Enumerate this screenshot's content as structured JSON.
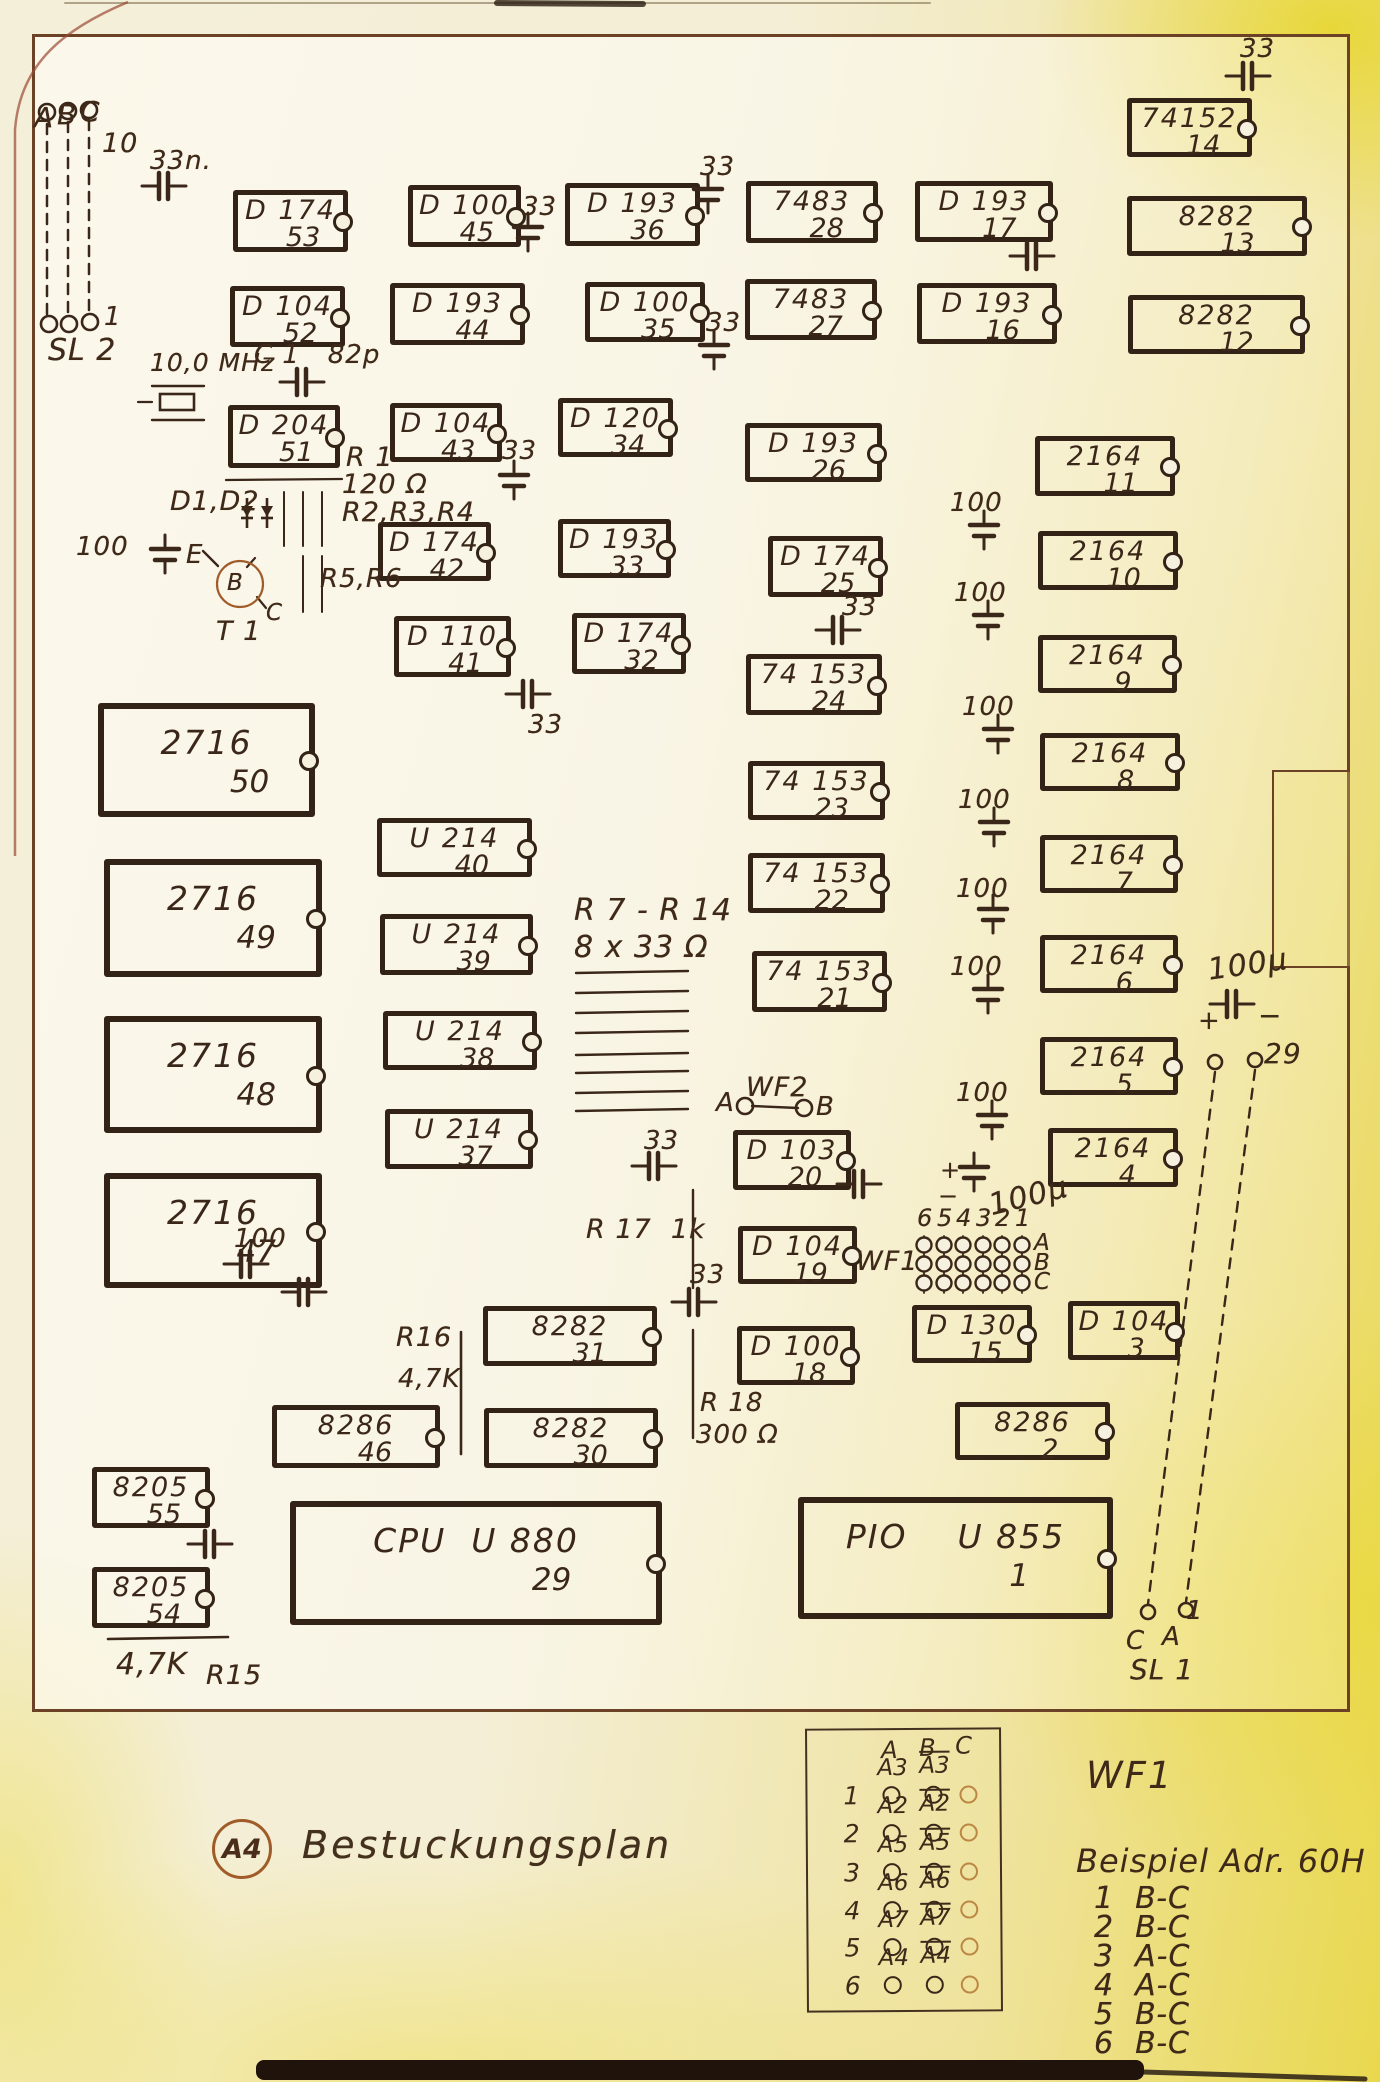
{
  "sheet": {
    "stamp": "A4",
    "caption": "Bestuckungsplan",
    "wf1_title": "WF1",
    "beispiel_title": "Beispiel  Adr. 60H"
  },
  "board": {
    "x": 32,
    "y": 34,
    "w": 1318,
    "h": 1678
  },
  "notch": {
    "x": 1272,
    "y": 770,
    "w": 78,
    "h": 198
  },
  "ics": [
    {
      "t": "D 174",
      "n": "53",
      "x": 233,
      "y": 190,
      "w": 115,
      "h": 62
    },
    {
      "t": "D 100",
      "n": "45",
      "x": 408,
      "y": 185,
      "w": 113,
      "h": 62
    },
    {
      "t": "D 193",
      "n": "36",
      "x": 565,
      "y": 183,
      "w": 135,
      "h": 63
    },
    {
      "t": "7483",
      "n": "28",
      "x": 746,
      "y": 181,
      "w": 132,
      "h": 62
    },
    {
      "t": "D 193",
      "n": "17",
      "x": 915,
      "y": 181,
      "w": 138,
      "h": 61
    },
    {
      "t": "74152",
      "n": "14",
      "x": 1127,
      "y": 98,
      "w": 125,
      "h": 59
    },
    {
      "t": "8282",
      "n": "13",
      "x": 1127,
      "y": 196,
      "w": 180,
      "h": 60
    },
    {
      "t": "D 104",
      "n": "52",
      "x": 230,
      "y": 286,
      "w": 115,
      "h": 61
    },
    {
      "t": "D 193",
      "n": "44",
      "x": 390,
      "y": 283,
      "w": 135,
      "h": 62
    },
    {
      "t": "D 100",
      "n": "35",
      "x": 585,
      "y": 282,
      "w": 120,
      "h": 60
    },
    {
      "t": "7483",
      "n": "27",
      "x": 745,
      "y": 279,
      "w": 132,
      "h": 61
    },
    {
      "t": "D 193",
      "n": "16",
      "x": 917,
      "y": 283,
      "w": 140,
      "h": 61
    },
    {
      "t": "8282",
      "n": "12",
      "x": 1128,
      "y": 295,
      "w": 177,
      "h": 59
    },
    {
      "t": "D 204",
      "n": "51",
      "x": 228,
      "y": 405,
      "w": 112,
      "h": 63
    },
    {
      "t": "D 104",
      "n": "43",
      "x": 390,
      "y": 403,
      "w": 112,
      "h": 59
    },
    {
      "t": "D 120",
      "n": "34",
      "x": 558,
      "y": 398,
      "w": 115,
      "h": 59
    },
    {
      "t": "D 193",
      "n": "26",
      "x": 745,
      "y": 423,
      "w": 137,
      "h": 59
    },
    {
      "t": "2164",
      "n": "11",
      "x": 1035,
      "y": 436,
      "w": 140,
      "h": 60
    },
    {
      "t": "D 174",
      "n": "42",
      "x": 378,
      "y": 522,
      "w": 113,
      "h": 59
    },
    {
      "t": "D 193",
      "n": "33",
      "x": 558,
      "y": 519,
      "w": 113,
      "h": 59
    },
    {
      "t": "D 174",
      "n": "25",
      "x": 768,
      "y": 536,
      "w": 115,
      "h": 61
    },
    {
      "t": "2164",
      "n": "10",
      "x": 1038,
      "y": 531,
      "w": 140,
      "h": 59
    },
    {
      "t": "D 110",
      "n": "41",
      "x": 394,
      "y": 616,
      "w": 117,
      "h": 61
    },
    {
      "t": "D 174",
      "n": "32",
      "x": 572,
      "y": 613,
      "w": 114,
      "h": 61
    },
    {
      "t": "74 153",
      "n": "24",
      "x": 746,
      "y": 654,
      "w": 136,
      "h": 61
    },
    {
      "t": "2164",
      "n": "9",
      "x": 1038,
      "y": 635,
      "w": 139,
      "h": 58
    },
    {
      "t": "2716",
      "n": "50",
      "x": 98,
      "y": 703,
      "w": 217,
      "h": 114,
      "big": 1
    },
    {
      "t": "U 214",
      "n": "40",
      "x": 377,
      "y": 818,
      "w": 155,
      "h": 59
    },
    {
      "t": "74 153",
      "n": "23",
      "x": 748,
      "y": 761,
      "w": 137,
      "h": 59
    },
    {
      "t": "2164",
      "n": "8",
      "x": 1040,
      "y": 733,
      "w": 140,
      "h": 58
    },
    {
      "t": "2716",
      "n": "49",
      "x": 104,
      "y": 859,
      "w": 218,
      "h": 118,
      "big": 1
    },
    {
      "t": "U 214",
      "n": "39",
      "x": 380,
      "y": 914,
      "w": 153,
      "h": 61
    },
    {
      "t": "74 153",
      "n": "22",
      "x": 748,
      "y": 853,
      "w": 137,
      "h": 60
    },
    {
      "t": "2164",
      "n": "7",
      "x": 1040,
      "y": 835,
      "w": 138,
      "h": 58
    },
    {
      "t": "U 214",
      "n": "38",
      "x": 383,
      "y": 1011,
      "w": 154,
      "h": 59
    },
    {
      "t": "74 153",
      "n": "21",
      "x": 752,
      "y": 951,
      "w": 135,
      "h": 61
    },
    {
      "t": "2164",
      "n": "6",
      "x": 1040,
      "y": 935,
      "w": 138,
      "h": 58
    },
    {
      "t": "2716",
      "n": "48",
      "x": 104,
      "y": 1016,
      "w": 218,
      "h": 117,
      "big": 1
    },
    {
      "t": "U 214",
      "n": "37",
      "x": 385,
      "y": 1109,
      "w": 148,
      "h": 60
    },
    {
      "t": "2164",
      "n": "5",
      "x": 1040,
      "y": 1037,
      "w": 138,
      "h": 58
    },
    {
      "t": "2716",
      "n": "47",
      "x": 104,
      "y": 1173,
      "w": 218,
      "h": 115,
      "big": 1
    },
    {
      "t": "D 103",
      "n": "20",
      "x": 733,
      "y": 1130,
      "w": 118,
      "h": 60
    },
    {
      "t": "2164",
      "n": "4",
      "x": 1048,
      "y": 1128,
      "w": 130,
      "h": 59
    },
    {
      "t": "D 104",
      "n": "19",
      "x": 738,
      "y": 1226,
      "w": 119,
      "h": 58
    },
    {
      "t": "D 100",
      "n": "18",
      "x": 737,
      "y": 1326,
      "w": 118,
      "h": 59
    },
    {
      "t": "D 130",
      "n": "15",
      "x": 912,
      "y": 1305,
      "w": 120,
      "h": 58
    },
    {
      "t": "D 104",
      "n": "3",
      "x": 1068,
      "y": 1301,
      "w": 112,
      "h": 59
    },
    {
      "t": "8282",
      "n": "31",
      "x": 483,
      "y": 1306,
      "w": 174,
      "h": 60
    },
    {
      "t": "8286",
      "n": "46",
      "x": 272,
      "y": 1405,
      "w": 168,
      "h": 63
    },
    {
      "t": "8282",
      "n": "30",
      "x": 484,
      "y": 1408,
      "w": 174,
      "h": 60
    },
    {
      "t": "8205",
      "n": "55",
      "x": 92,
      "y": 1467,
      "w": 118,
      "h": 61
    },
    {
      "t": "8205",
      "n": "54",
      "x": 92,
      "y": 1567,
      "w": 118,
      "h": 61
    },
    {
      "t": "8286",
      "n": "2",
      "x": 955,
      "y": 1402,
      "w": 155,
      "h": 58
    },
    {
      "t": "CPU  U 880",
      "n": "29",
      "x": 290,
      "y": 1501,
      "w": 372,
      "h": 124,
      "big": 1
    },
    {
      "t": "PIO    U 855",
      "n": "1",
      "x": 798,
      "y": 1497,
      "w": 315,
      "h": 122,
      "big": 1
    }
  ],
  "caps": [
    {
      "o": "h",
      "x": 162,
      "y": 186,
      "lab": "33n.",
      "lx": 150,
      "ly": 148
    },
    {
      "o": "v",
      "x": 528,
      "y": 230,
      "lab": "33",
      "lx": 522,
      "ly": 194
    },
    {
      "o": "v",
      "x": 708,
      "y": 192,
      "lab": "33",
      "lx": 700,
      "ly": 154
    },
    {
      "o": "v",
      "x": 714,
      "y": 348,
      "lab": "33",
      "lx": 706,
      "ly": 310
    },
    {
      "o": "h",
      "x": 1246,
      "y": 76,
      "lab": "33",
      "lx": 1240,
      "ly": 36
    },
    {
      "o": "h",
      "x": 1030,
      "y": 256
    },
    {
      "o": "h",
      "x": 300,
      "y": 382,
      "lab": "C 1   82p",
      "lx": 254,
      "ly": 342
    },
    {
      "o": "v",
      "x": 514,
      "y": 478,
      "lab": "33",
      "lx": 502,
      "ly": 438
    },
    {
      "o": "h",
      "x": 836,
      "y": 630,
      "lab": "33",
      "lx": 842,
      "ly": 594
    },
    {
      "o": "h",
      "x": 526,
      "y": 694,
      "lab": "33",
      "lx": 528,
      "ly": 712
    },
    {
      "o": "v",
      "x": 165,
      "y": 552
    },
    {
      "o": "v",
      "x": 984,
      "y": 528,
      "lab": "100",
      "lx": 950,
      "ly": 490
    },
    {
      "o": "v",
      "x": 988,
      "y": 618,
      "lab": "100",
      "lx": 954,
      "ly": 580
    },
    {
      "o": "v",
      "x": 998,
      "y": 732,
      "lab": "100",
      "lx": 962,
      "ly": 694
    },
    {
      "o": "v",
      "x": 994,
      "y": 825,
      "lab": "100",
      "lx": 958,
      "ly": 787
    },
    {
      "o": "v",
      "x": 993,
      "y": 912,
      "lab": "100",
      "lx": 956,
      "ly": 876
    },
    {
      "o": "v",
      "x": 988,
      "y": 992,
      "lab": "100",
      "lx": 950,
      "ly": 954
    },
    {
      "o": "v",
      "x": 992,
      "y": 1118,
      "lab": "100",
      "lx": 956,
      "ly": 1080
    },
    {
      "o": "h",
      "x": 1230,
      "y": 1004
    },
    {
      "o": "v",
      "x": 974,
      "y": 1170
    },
    {
      "o": "h",
      "x": 857,
      "y": 1184
    },
    {
      "o": "h",
      "x": 652,
      "y": 1166,
      "lab": "33",
      "lx": 644,
      "ly": 1128
    },
    {
      "o": "h",
      "x": 692,
      "y": 1302,
      "lab": "33",
      "lx": 690,
      "ly": 1262
    },
    {
      "o": "h",
      "x": 244,
      "y": 1264,
      "lab": "100",
      "lx": 234,
      "ly": 1226
    },
    {
      "o": "h",
      "x": 302,
      "y": 1292
    },
    {
      "o": "h",
      "x": 208,
      "y": 1544
    }
  ],
  "labels": [
    {
      "t": "A",
      "x": 34,
      "y": 104,
      "s": 28
    },
    {
      "t": "B",
      "x": 57,
      "y": 101,
      "s": 28
    },
    {
      "t": "C",
      "x": 80,
      "y": 98,
      "s": 28
    },
    {
      "t": "10",
      "x": 102,
      "y": 130,
      "s": 27
    },
    {
      "t": "1",
      "x": 104,
      "y": 304,
      "s": 26
    },
    {
      "t": "SL 2",
      "x": 48,
      "y": 336,
      "s": 30
    },
    {
      "t": "10,0 MHz",
      "x": 150,
      "y": 350,
      "s": 25
    },
    {
      "t": "R 1",
      "x": 346,
      "y": 444,
      "s": 27
    },
    {
      "t": "120 Ω",
      "x": 342,
      "y": 471,
      "s": 27
    },
    {
      "t": "R2,R3,R4",
      "x": 342,
      "y": 499,
      "s": 27
    },
    {
      "t": "D1,D2",
      "x": 170,
      "y": 488,
      "s": 27
    },
    {
      "t": "100",
      "x": 76,
      "y": 534,
      "s": 26
    },
    {
      "t": "E",
      "x": 186,
      "y": 542,
      "s": 26
    },
    {
      "t": "B",
      "x": 227,
      "y": 572,
      "s": 23
    },
    {
      "t": "C",
      "x": 266,
      "y": 602,
      "s": 23
    },
    {
      "t": "T 1",
      "x": 216,
      "y": 618,
      "s": 27
    },
    {
      "t": "R5,R6",
      "x": 320,
      "y": 566,
      "s": 26
    },
    {
      "t": "R 7 - R 14",
      "x": 574,
      "y": 896,
      "s": 30
    },
    {
      "t": "8 x 33 Ω",
      "x": 574,
      "y": 933,
      "s": 30
    },
    {
      "t": "WF2",
      "x": 746,
      "y": 1074,
      "s": 27
    },
    {
      "t": "A",
      "x": 716,
      "y": 1090,
      "s": 26
    },
    {
      "t": "B",
      "x": 816,
      "y": 1094,
      "s": 26
    },
    {
      "t": "R 17  1k",
      "x": 586,
      "y": 1216,
      "s": 27
    },
    {
      "t": "R16",
      "x": 396,
      "y": 1324,
      "s": 27
    },
    {
      "t": "4,7K",
      "x": 398,
      "y": 1366,
      "s": 26
    },
    {
      "t": "R 18",
      "x": 700,
      "y": 1390,
      "s": 26
    },
    {
      "t": "300 Ω",
      "x": 696,
      "y": 1422,
      "s": 26
    },
    {
      "t": "4,7K",
      "x": 116,
      "y": 1650,
      "s": 30
    },
    {
      "t": "R15",
      "x": 206,
      "y": 1662,
      "s": 27
    },
    {
      "t": "WF1",
      "x": 856,
      "y": 1248,
      "s": 27
    },
    {
      "t": "A",
      "x": 1034,
      "y": 1232,
      "s": 23
    },
    {
      "t": "B",
      "x": 1034,
      "y": 1252,
      "s": 23
    },
    {
      "t": "C",
      "x": 1034,
      "y": 1271,
      "s": 23
    },
    {
      "t": "29",
      "x": 1264,
      "y": 1040,
      "s": 28
    },
    {
      "t": "1",
      "x": 1186,
      "y": 1598,
      "s": 26
    },
    {
      "t": "C",
      "x": 1126,
      "y": 1628,
      "s": 26
    },
    {
      "t": "A",
      "x": 1162,
      "y": 1624,
      "s": 26
    },
    {
      "t": "SL 1",
      "x": 1130,
      "y": 1656,
      "s": 28
    },
    {
      "t": "+",
      "x": 1198,
      "y": 1008,
      "s": 26
    },
    {
      "t": "−",
      "x": 1258,
      "y": 1002,
      "s": 28
    },
    {
      "t": "100µ",
      "x": 1206,
      "y": 956,
      "s": 30,
      "r": -8
    },
    {
      "t": "+",
      "x": 940,
      "y": 1158,
      "s": 24
    },
    {
      "t": "−",
      "x": 938,
      "y": 1184,
      "s": 24
    },
    {
      "t": "100µ",
      "x": 986,
      "y": 1192,
      "s": 30,
      "r": -14
    }
  ],
  "lines": [
    {
      "x1": 47,
      "y1": 124,
      "x2": 47,
      "y2": 314,
      "w": 2.5,
      "d": "10 8"
    },
    {
      "x1": 68,
      "y1": 122,
      "x2": 68,
      "y2": 314,
      "w": 2.5,
      "d": "10 8"
    },
    {
      "x1": 89,
      "y1": 120,
      "x2": 89,
      "y2": 314,
      "w": 2.5,
      "d": "10 8"
    },
    {
      "x1": 226,
      "y1": 480,
      "x2": 342,
      "y2": 479,
      "w": 2.2
    },
    {
      "x1": 284,
      "y1": 492,
      "x2": 284,
      "y2": 546,
      "w": 2
    },
    {
      "x1": 303,
      "y1": 492,
      "x2": 303,
      "y2": 546,
      "w": 2
    },
    {
      "x1": 322,
      "y1": 492,
      "x2": 322,
      "y2": 546,
      "w": 2
    },
    {
      "x1": 303,
      "y1": 556,
      "x2": 303,
      "y2": 612,
      "w": 2
    },
    {
      "x1": 322,
      "y1": 556,
      "x2": 322,
      "y2": 612,
      "w": 2
    },
    {
      "x1": 576,
      "y1": 973,
      "x2": 688,
      "y2": 971,
      "w": 2.4
    },
    {
      "x1": 576,
      "y1": 993,
      "x2": 688,
      "y2": 991,
      "w": 2.4
    },
    {
      "x1": 576,
      "y1": 1013,
      "x2": 688,
      "y2": 1011,
      "w": 2.4
    },
    {
      "x1": 576,
      "y1": 1033,
      "x2": 688,
      "y2": 1031,
      "w": 2.4
    },
    {
      "x1": 576,
      "y1": 1055,
      "x2": 688,
      "y2": 1053,
      "w": 2.4
    },
    {
      "x1": 576,
      "y1": 1073,
      "x2": 688,
      "y2": 1071,
      "w": 2.4
    },
    {
      "x1": 576,
      "y1": 1093,
      "x2": 688,
      "y2": 1091,
      "w": 2.4
    },
    {
      "x1": 576,
      "y1": 1111,
      "x2": 688,
      "y2": 1109,
      "w": 2.4
    },
    {
      "x1": 108,
      "y1": 1639,
      "x2": 228,
      "y2": 1637,
      "w": 2.6
    },
    {
      "x1": 461,
      "y1": 1332,
      "x2": 461,
      "y2": 1454,
      "w": 2.6
    },
    {
      "x1": 693,
      "y1": 1190,
      "x2": 693,
      "y2": 1288,
      "w": 2.4
    },
    {
      "x1": 693,
      "y1": 1330,
      "x2": 693,
      "y2": 1438,
      "w": 2.4
    },
    {
      "x1": 1215,
      "y1": 1072,
      "x2": 1148,
      "y2": 1604,
      "w": 2.4,
      "d": "10 9"
    },
    {
      "x1": 1255,
      "y1": 1070,
      "x2": 1186,
      "y2": 1602,
      "w": 2.4,
      "d": "10 9"
    },
    {
      "x1": 752,
      "y1": 1106,
      "x2": 798,
      "y2": 1108,
      "w": 2.4
    },
    {
      "x1": 203,
      "y1": 551,
      "x2": 218,
      "y2": 566,
      "w": 2.4
    },
    {
      "x1": 247,
      "y1": 567,
      "x2": 255,
      "y2": 558,
      "w": 2.2
    },
    {
      "x1": 257,
      "y1": 597,
      "x2": 266,
      "y2": 608,
      "w": 2.2
    },
    {
      "x1": 138,
      "y1": 402,
      "x2": 152,
      "y2": 402,
      "w": 2.2
    },
    {
      "x1": 152,
      "y1": 386,
      "x2": 204,
      "y2": 386,
      "w": 2.4
    },
    {
      "x1": 152,
      "y1": 420,
      "x2": 204,
      "y2": 420,
      "w": 2.4
    },
    {
      "x1": 65,
      "y1": 3,
      "x2": 930,
      "y2": 3,
      "w": 2,
      "c": "rgba(90,74,40,0.45)"
    },
    {
      "x1": 497,
      "y1": 3,
      "x2": 643,
      "y2": 4,
      "w": 6,
      "c": "rgba(40,28,16,0.8)"
    },
    {
      "x1": 1142,
      "y1": 2072,
      "x2": 1365,
      "y2": 2079,
      "w": 5,
      "c": "rgba(42,30,20,0.85)"
    }
  ],
  "circles": [
    {
      "cx": 47,
      "cy": 112,
      "r": 8
    },
    {
      "cx": 68,
      "cy": 111,
      "r": 8
    },
    {
      "cx": 89,
      "cy": 110,
      "r": 8
    },
    {
      "cx": 49,
      "cy": 324,
      "r": 8
    },
    {
      "cx": 69,
      "cy": 324,
      "r": 8
    },
    {
      "cx": 90,
      "cy": 322,
      "r": 8
    },
    {
      "cx": 1215,
      "cy": 1062,
      "r": 7
    },
    {
      "cx": 1255,
      "cy": 1060,
      "r": 7
    },
    {
      "cx": 1148,
      "cy": 1612,
      "r": 7
    },
    {
      "cx": 1186,
      "cy": 1610,
      "r": 7
    },
    {
      "cx": 745,
      "cy": 1106,
      "r": 8
    },
    {
      "cx": 804,
      "cy": 1108,
      "r": 8
    }
  ],
  "diodes": [
    {
      "x": 247,
      "y": 504
    },
    {
      "x": 267,
      "y": 504
    }
  ],
  "transistor": {
    "cx": 240,
    "cy": 584,
    "r": 23
  },
  "crystal": {
    "x": 160,
    "y": 394,
    "w": 34,
    "h": 16
  },
  "red_path": "M128,2 C66,28 20,62 15,130 L15,856",
  "wf1": {
    "cols": [
      924,
      944,
      963,
      983,
      1002,
      1022
    ],
    "rows": [
      1245,
      1264,
      1283
    ],
    "digits": [
      "6",
      "5",
      "4",
      "3",
      "2",
      "1"
    ],
    "digit_y": 1206
  },
  "legend": {
    "x": 806,
    "y": 1728,
    "w": 196,
    "h": 284,
    "headers": [
      "A",
      "B",
      "C"
    ],
    "header_pos": [
      [
        74,
        8
      ],
      [
        112,
        6
      ],
      [
        148,
        4
      ]
    ],
    "col_x": [
      84,
      126,
      161
    ],
    "rows": [
      {
        "n": "1",
        "a": "A3",
        "b": "A3",
        "y": 1793
      },
      {
        "n": "2",
        "a": "A2",
        "b": "A2",
        "y": 1831
      },
      {
        "n": "3",
        "a": "A5",
        "b": "A5",
        "y": 1870
      },
      {
        "n": "4",
        "a": "A6",
        "b": "A6",
        "y": 1908
      },
      {
        "n": "5",
        "a": "A7",
        "b": "A7",
        "y": 1945
      },
      {
        "n": "6",
        "a": "A4",
        "b": "A4",
        "y": 1983
      }
    ]
  },
  "beispiel_rows": [
    "1  B-C",
    "2  B-C",
    "3  A-C",
    "4  A-C",
    "5  B-C",
    "6  B-C"
  ],
  "band": {
    "x": 256,
    "y": 2060,
    "w": 888,
    "h": 20
  },
  "colors": {
    "ink": "#3a2719",
    "outline": "#6b4226",
    "accent": "#a05c28",
    "paper": "#f6f1de"
  }
}
